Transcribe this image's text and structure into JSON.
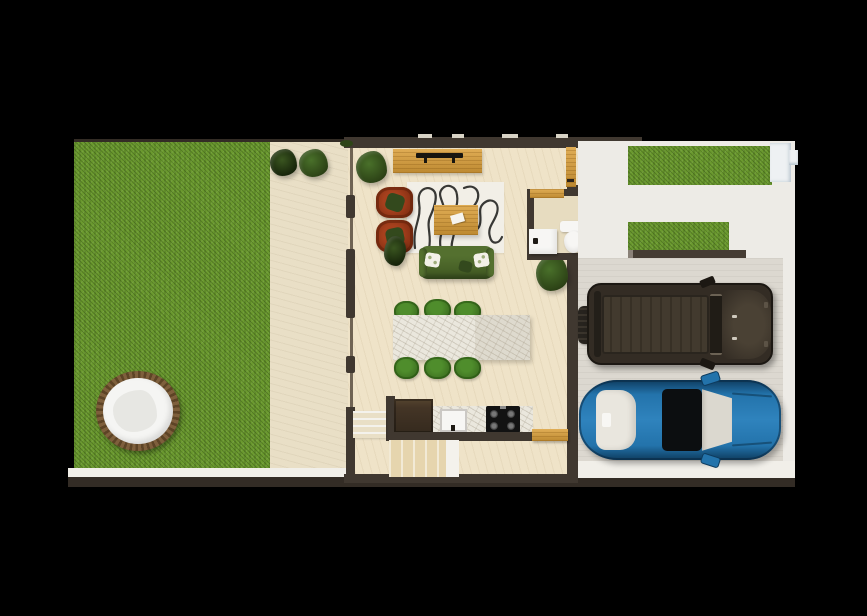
{
  "canvas": {
    "width": 867,
    "height": 616,
    "background": "#000000"
  },
  "palette": {
    "background": "#000000",
    "grass": "#6b9a2f",
    "patio": "#e9dfc6",
    "floor": "#efe3c8",
    "bath_floor": "#e7dcc0",
    "wall": "#403830",
    "wall_dark": "#332c25",
    "walkway": "#edebe6",
    "garage_floor": "#dcd8d0",
    "sidewalk": "#f1efe9",
    "wood": "#e0ad55",
    "wood_dark": "#bd8931",
    "tv_black": "#18150f",
    "rug": "#f2efe7",
    "rug_line": "#1f1f1d",
    "armchair": "#a6401d",
    "armchair_dark": "#78290f",
    "sofa": "#54702f",
    "sofa_dark": "#3e5621",
    "pillow_floral": "#f3f1e8",
    "pillow_green": "#33491d",
    "chair_green": "#4f8d2c",
    "chair_green_dark": "#38671d",
    "counter_marble": "#eae7dd",
    "fridge": "#443526",
    "stove": "#121212",
    "porcelain": "#f7f6f4",
    "stairs_tread": "#e6d5ae",
    "stairs_light": "#f2ead6",
    "landing": "#f4f2ec",
    "tub_rim": "#7e5f3c",
    "tub_white": "#f5f5f3",
    "tub_water": "#e7e7e3",
    "plant_dark": "#2e4517",
    "plant_mid": "#49702a",
    "suv_body": "#332c24",
    "suv_roof": "#423a2e",
    "suv_hood": "#4a4134",
    "suv_trim": "#1c1813",
    "car_blue": "#2373ab",
    "car_blue_light": "#2f83bd",
    "car_blue_dark": "#0e3c5f",
    "car_glass": "#0c0e10",
    "car_ivory": "#e9e6de",
    "wall_cap": "#eef1f3",
    "roof_notch": "#d8d3c6"
  },
  "objects": [
    "backyard-lawn",
    "hot-tub",
    "patio",
    "patio-plants",
    "living-room",
    "tv-console",
    "tv",
    "rug",
    "armchairs",
    "coffee-table",
    "sofa",
    "dining-table",
    "dining-chairs",
    "kitchen-fridge",
    "kitchen-sink",
    "kitchen-stove",
    "staircase",
    "bathroom",
    "toilet",
    "bathroom-sink",
    "front-hedges",
    "driveway",
    "garage",
    "suv-car",
    "blue-sedan"
  ]
}
